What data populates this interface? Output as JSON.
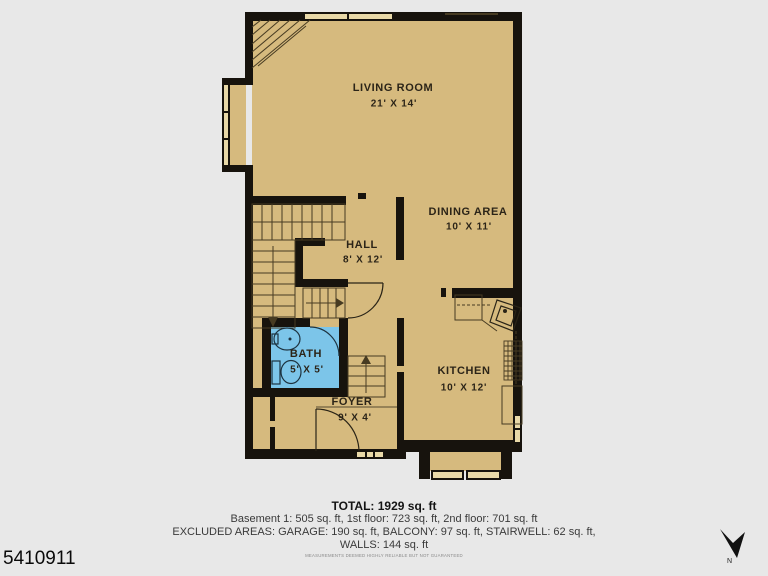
{
  "page": {
    "background": "#e8e8e8"
  },
  "plan": {
    "colors": {
      "floor": "#d6ba7e",
      "wall": "#17130d",
      "bath": "#7cc5e9",
      "window": "#e9d9a8",
      "line": "#473b22",
      "label": "#2b2418"
    },
    "rooms": [
      {
        "name": "LIVING ROOM",
        "dims": "21' X 14'"
      },
      {
        "name": "DINING AREA",
        "dims": "10' X 11'"
      },
      {
        "name": "HALL",
        "dims": "8' X 12'"
      },
      {
        "name": "BATH",
        "dims": "5' X 5'"
      },
      {
        "name": "FOYER",
        "dims": "9' X 4'"
      },
      {
        "name": "KITCHEN",
        "dims": "10' X 12'"
      }
    ]
  },
  "footer": {
    "total": "TOTAL: 1929 sq. ft",
    "line1": "Basement 1: 505 sq. ft, 1st floor: 723 sq. ft, 2nd floor: 701 sq. ft",
    "line2": "EXCLUDED AREAS: GARAGE: 190 sq. ft, BALCONY: 97 sq. ft, STAIRWELL: 62 sq. ft,",
    "line3": "WALLS: 144 sq. ft",
    "disclaimer": "MEASUREMENTS DEEMED HIGHLY RELIABLE BUT NOT GUARANTEED"
  },
  "watermark": {
    "id": "5410911"
  },
  "compass": {
    "label": "N"
  }
}
